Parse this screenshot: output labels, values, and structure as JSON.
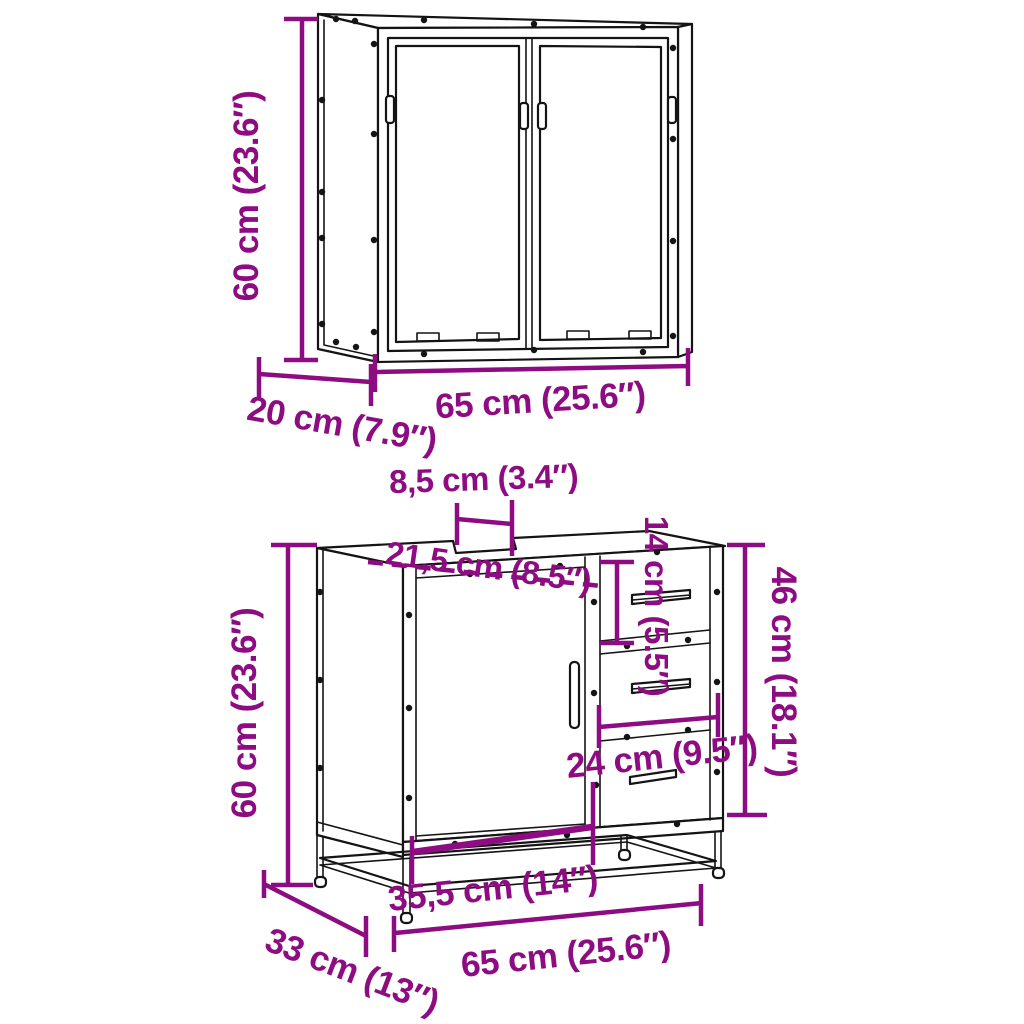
{
  "diagram": {
    "type": "furniture dimension diagram",
    "background": "#ffffff",
    "accent_color": "#8E0C82",
    "line_color": "#141414",
    "pieces": [
      "wall mirror cabinet",
      "bathroom sink cabinet"
    ]
  },
  "mirror_cabinet": {
    "name": "wall mirror cabinet with two mirror doors",
    "height": "60 cm (23.6″)",
    "depth": "20 cm (7.9″)",
    "width": "65 cm (25.6″)"
  },
  "sink_cabinet": {
    "name": "bathroom sink cabinet with door, two drawers and open bottom shelf",
    "height": "60 cm (23.6″)",
    "depth": "33 cm (13″)",
    "width": "65 cm (25.6″)",
    "cutout_width": "8,5 cm (3.4″)",
    "cutout_offset": "21,5 cm (8.5″)",
    "top_drawer_height": "14 cm (5.5″)",
    "side_opening_height": "46 cm (18.1″)",
    "drawer_width": "24 cm (9.5″)",
    "bottom_shelf_width": "35,5 cm (14″)"
  }
}
